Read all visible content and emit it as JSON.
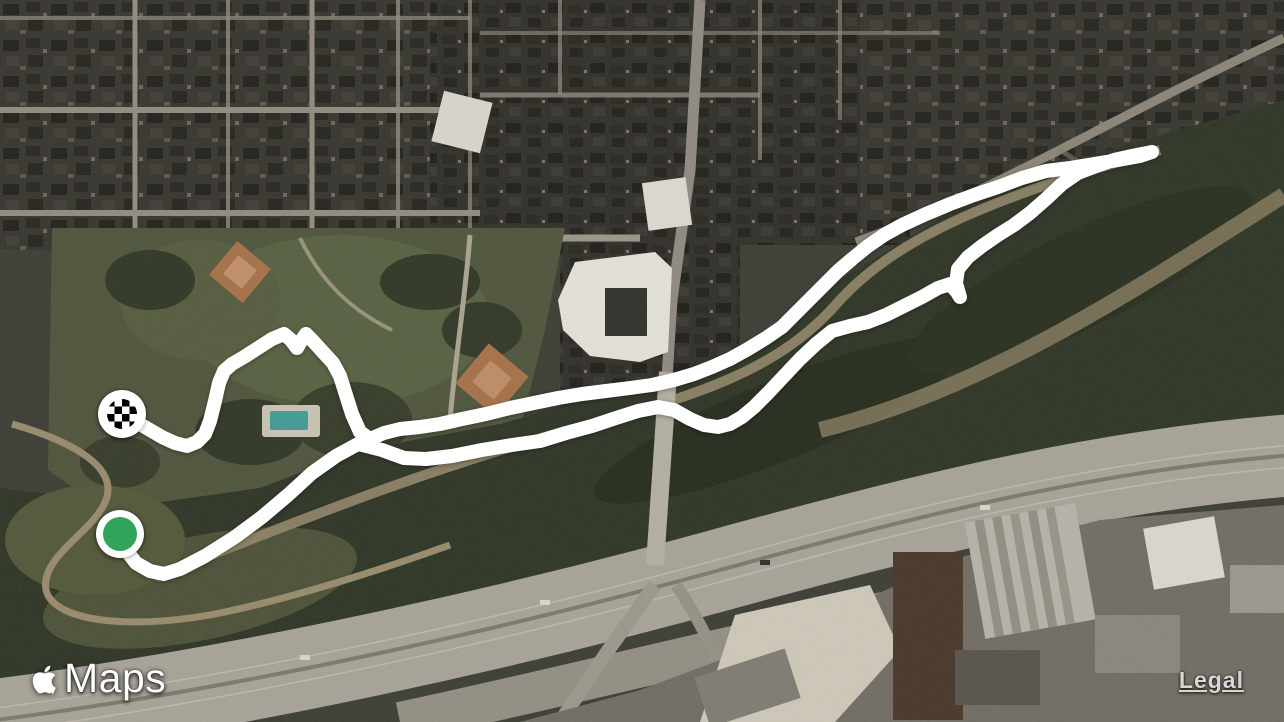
{
  "attribution": {
    "brand_label": "Maps",
    "apple_logo_icon": "apple-icon",
    "legal_label": "Legal"
  },
  "map": {
    "style": "satellite",
    "route": {
      "color": "#ffffff",
      "stroke_width": 14,
      "points": [
        [
          120,
          534
        ],
        [
          126,
          550
        ],
        [
          136,
          563
        ],
        [
          150,
          571
        ],
        [
          164,
          574
        ],
        [
          180,
          569
        ],
        [
          205,
          556
        ],
        [
          235,
          537
        ],
        [
          262,
          517
        ],
        [
          288,
          495
        ],
        [
          312,
          473
        ],
        [
          336,
          456
        ],
        [
          358,
          444
        ],
        [
          382,
          450
        ],
        [
          404,
          458
        ],
        [
          426,
          459
        ],
        [
          452,
          456
        ],
        [
          482,
          450
        ],
        [
          512,
          445
        ],
        [
          540,
          441
        ],
        [
          566,
          433
        ],
        [
          592,
          426
        ],
        [
          616,
          418
        ],
        [
          638,
          411
        ],
        [
          658,
          407
        ],
        [
          674,
          410
        ],
        [
          690,
          419
        ],
        [
          704,
          425
        ],
        [
          718,
          427
        ],
        [
          730,
          424
        ],
        [
          742,
          417
        ],
        [
          754,
          407
        ],
        [
          768,
          393
        ],
        [
          784,
          376
        ],
        [
          800,
          359
        ],
        [
          816,
          344
        ],
        [
          832,
          331
        ],
        [
          850,
          326
        ],
        [
          868,
          322
        ],
        [
          886,
          315
        ],
        [
          904,
          306
        ],
        [
          922,
          297
        ],
        [
          938,
          288
        ],
        [
          950,
          284
        ],
        [
          957,
          292
        ],
        [
          960,
          297
        ],
        [
          956,
          283
        ],
        [
          958,
          269
        ],
        [
          968,
          257
        ],
        [
          982,
          246
        ],
        [
          998,
          235
        ],
        [
          1014,
          225
        ],
        [
          1030,
          213
        ],
        [
          1046,
          199
        ],
        [
          1062,
          184
        ],
        [
          1078,
          173
        ],
        [
          1096,
          166
        ],
        [
          1114,
          160
        ],
        [
          1132,
          156
        ],
        [
          1152,
          152
        ],
        [
          1140,
          156
        ],
        [
          1118,
          160
        ],
        [
          1094,
          164
        ],
        [
          1070,
          168
        ],
        [
          1046,
          171
        ],
        [
          1022,
          178
        ],
        [
          998,
          187
        ],
        [
          974,
          195
        ],
        [
          950,
          204
        ],
        [
          926,
          214
        ],
        [
          902,
          225
        ],
        [
          884,
          235
        ],
        [
          868,
          246
        ],
        [
          852,
          259
        ],
        [
          838,
          271
        ],
        [
          824,
          285
        ],
        [
          810,
          299
        ],
        [
          796,
          313
        ],
        [
          782,
          327
        ],
        [
          766,
          338
        ],
        [
          748,
          349
        ],
        [
          730,
          359
        ],
        [
          712,
          367
        ],
        [
          694,
          374
        ],
        [
          674,
          380
        ],
        [
          652,
          385
        ],
        [
          630,
          388
        ],
        [
          606,
          391
        ],
        [
          582,
          394
        ],
        [
          558,
          398
        ],
        [
          534,
          403
        ],
        [
          510,
          408
        ],
        [
          486,
          414
        ],
        [
          462,
          419
        ],
        [
          440,
          424
        ],
        [
          420,
          427
        ],
        [
          400,
          429
        ],
        [
          384,
          433
        ],
        [
          370,
          439
        ],
        [
          360,
          432
        ],
        [
          352,
          414
        ],
        [
          346,
          395
        ],
        [
          340,
          376
        ],
        [
          333,
          363
        ],
        [
          322,
          351
        ],
        [
          312,
          340
        ],
        [
          306,
          334
        ],
        [
          301,
          341
        ],
        [
          297,
          348
        ],
        [
          291,
          340
        ],
        [
          284,
          334
        ],
        [
          272,
          339
        ],
        [
          258,
          348
        ],
        [
          244,
          357
        ],
        [
          232,
          364
        ],
        [
          224,
          371
        ],
        [
          219,
          383
        ],
        [
          215,
          401
        ],
        [
          210,
          421
        ],
        [
          205,
          434
        ],
        [
          197,
          442
        ],
        [
          187,
          446
        ],
        [
          175,
          443
        ],
        [
          162,
          437
        ],
        [
          150,
          430
        ],
        [
          138,
          423
        ],
        [
          128,
          417
        ],
        [
          122,
          414
        ]
      ],
      "start_marker": {
        "label": "start",
        "x": 120,
        "y": 534,
        "ring_color": "#ffffff",
        "fill_color": "#2fa45a",
        "radius": 24,
        "inner_radius": 17
      },
      "finish_marker": {
        "label": "finish",
        "x": 122,
        "y": 414,
        "ring_color": "#ffffff",
        "checker_colors": [
          "#000000",
          "#ffffff"
        ],
        "radius": 24,
        "inner_radius": 15,
        "cell_size": 7.5
      }
    },
    "palette": {
      "terrain_base": "#3a3c32",
      "park_green": "#4d5339",
      "bayou_green": "#2c3323",
      "freeway_gray": "#a7a297",
      "trail_tan": "#8c8164",
      "street_gray": "#918a7c"
    }
  }
}
